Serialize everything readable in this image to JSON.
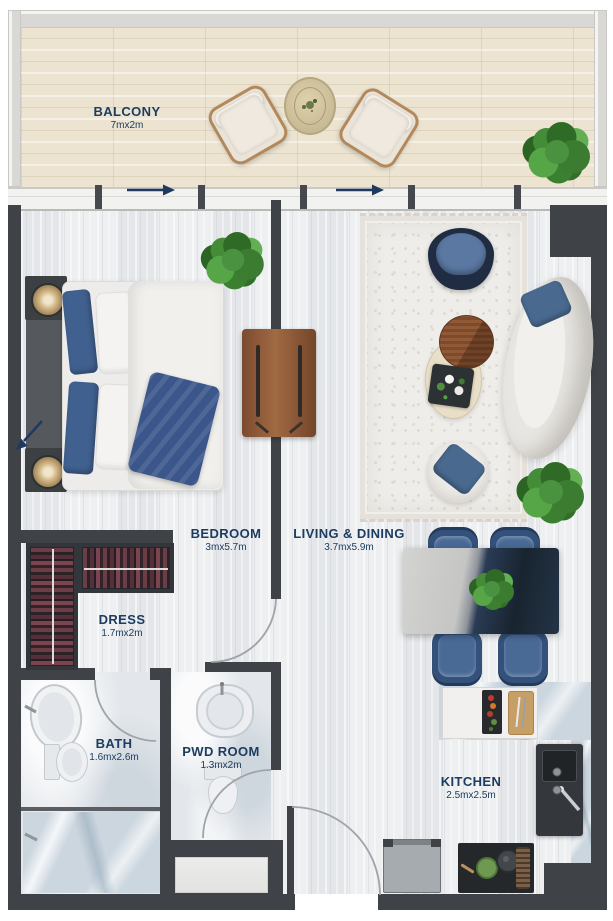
{
  "plan": {
    "type": "apartment-floor-plan",
    "rooms": {
      "balcony": {
        "name": "BALCONY",
        "dims": "7mx2m"
      },
      "bedroom": {
        "name": "BEDROOM",
        "dims": "3mx5.7m"
      },
      "living_dining": {
        "name": "LIVING & DINING",
        "dims": "3.7mx5.9m"
      },
      "dress": {
        "name": "DRESS",
        "dims": "1.7mx2m"
      },
      "bath": {
        "name": "BATH",
        "dims": "1.6mx2.6m"
      },
      "pwd_room": {
        "name": "PWD ROOM",
        "dims": "1.3mx2m"
      },
      "kitchen": {
        "name": "KITCHEN",
        "dims": "2.5mx2.5m"
      }
    },
    "icons": {
      "sliding_door_arrow": "right-arrow",
      "entrance_arrow": "diagonal-down-left-arrow"
    },
    "colors": {
      "label_text": "#1d3c61",
      "wall": "#3f4347",
      "balcony_floor": "#ece4d1",
      "accent_navy": "#3f5f8f",
      "wood": "#8a5334"
    }
  }
}
